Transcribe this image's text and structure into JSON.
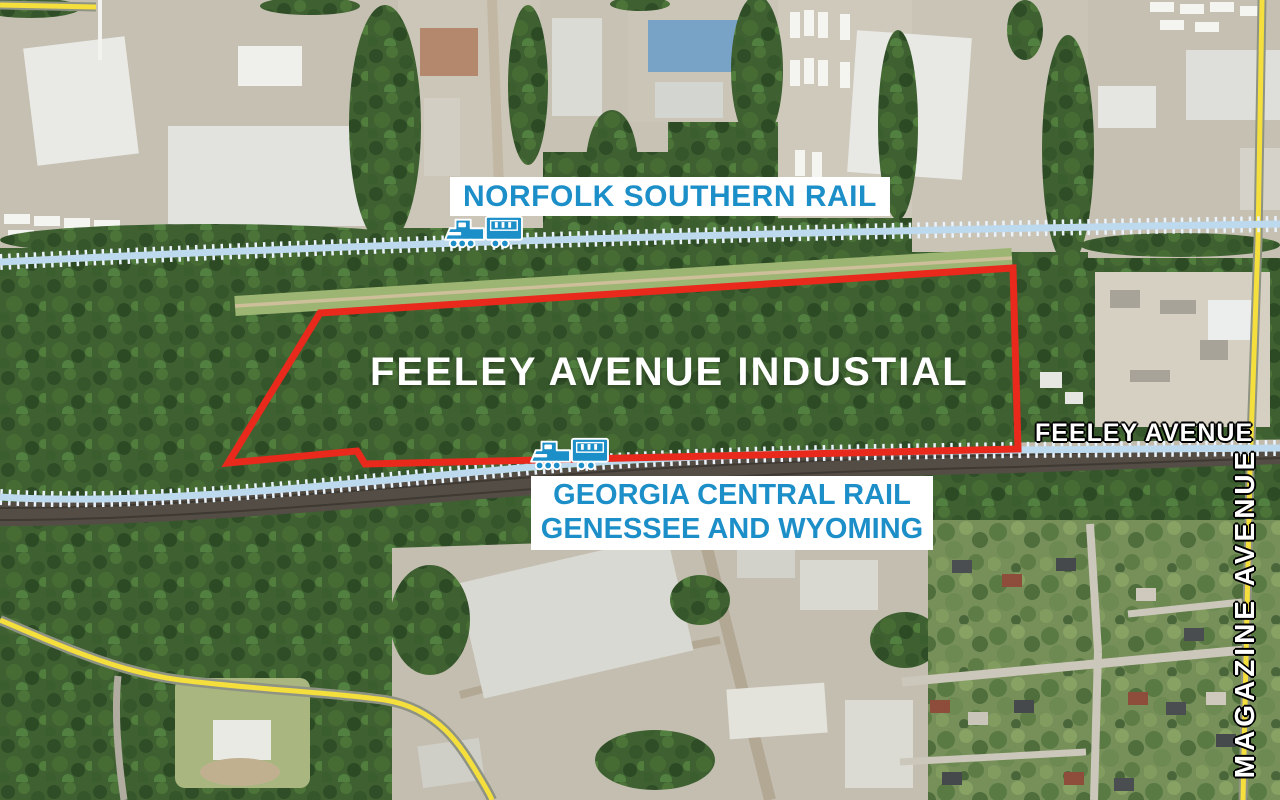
{
  "map": {
    "region_title": "FEELEY AVENUE INDUSTIAL",
    "labels": {
      "norfolk_rail": "NORFOLK SOUTHERN RAIL",
      "georgia_rail_line1": "GEORGIA CENTRAL RAIL",
      "georgia_rail_line2": "GENESSEE AND WYOMING",
      "feeley_avenue": "FEELEY AVENUE",
      "magazine_avenue": "MAGAZINE AVENUE"
    },
    "icons": {
      "norfolk_train": "train-icon",
      "georgia_train": "train-icon"
    },
    "colors": {
      "rail_label_blue": "#1d8fc8",
      "site_boundary_red": "#e8291c",
      "road_yellow": "#f4df3d",
      "rail_line_blue": "#bdd9ee",
      "street_label_white": "#ffffff"
    }
  }
}
